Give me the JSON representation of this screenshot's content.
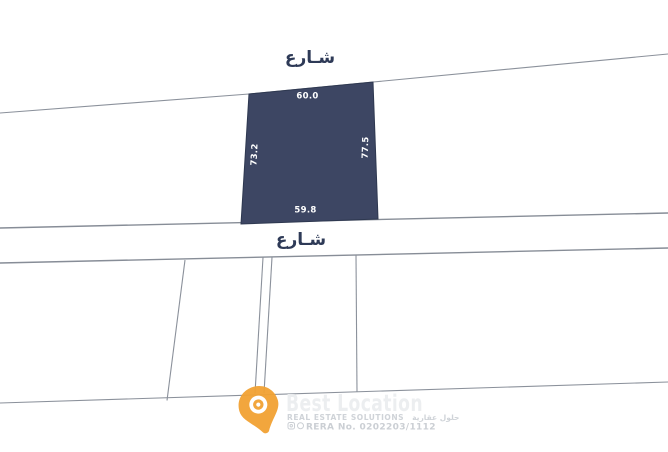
{
  "map": {
    "streets": {
      "top_label": "شـارع",
      "bottom_label": "شـارع"
    },
    "parcel": {
      "dimensions": {
        "top": "60.0",
        "bottom": "59.8",
        "left": "73.2",
        "right": "77.5"
      },
      "fill_color": "#3d4663"
    },
    "colors": {
      "boundary_line": "#8b919b",
      "street_label": "#2e3a57",
      "dimension_text": "#ffffff"
    }
  },
  "watermark": {
    "brand": "Best Location",
    "tagline_en": "REAL ESTATE SOLUTIONS",
    "tagline_ar": "حلول عقارية",
    "rera": "RERA No. 0202203/1112",
    "pin_color": "#f2a233",
    "icons": [
      "instagram-icon",
      "phone-icon"
    ]
  }
}
